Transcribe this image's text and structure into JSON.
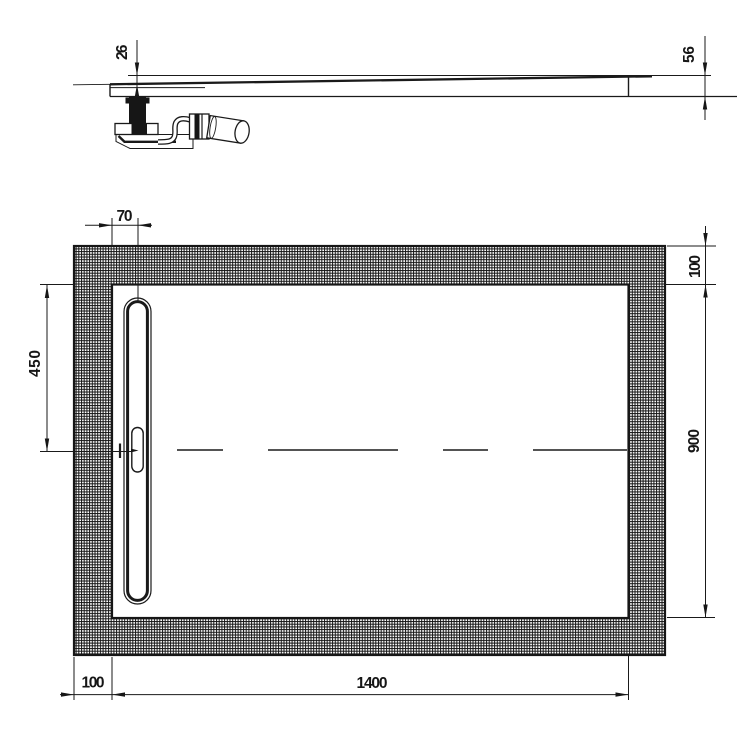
{
  "drawing": {
    "background": "#ffffff",
    "line_color": "#1a1a1a",
    "views": {
      "side_profile": "shower-tray-side-profile-with-waste-trap",
      "plan": "shower-tray-plan-view"
    },
    "dimensions": {
      "profile_depth_min": "26",
      "profile_depth_max": "56",
      "drain_offset": "70",
      "drain_center_from_top": "450",
      "border_top": "100",
      "inner_height": "900",
      "border_left": "100",
      "inner_width": "1400"
    }
  }
}
